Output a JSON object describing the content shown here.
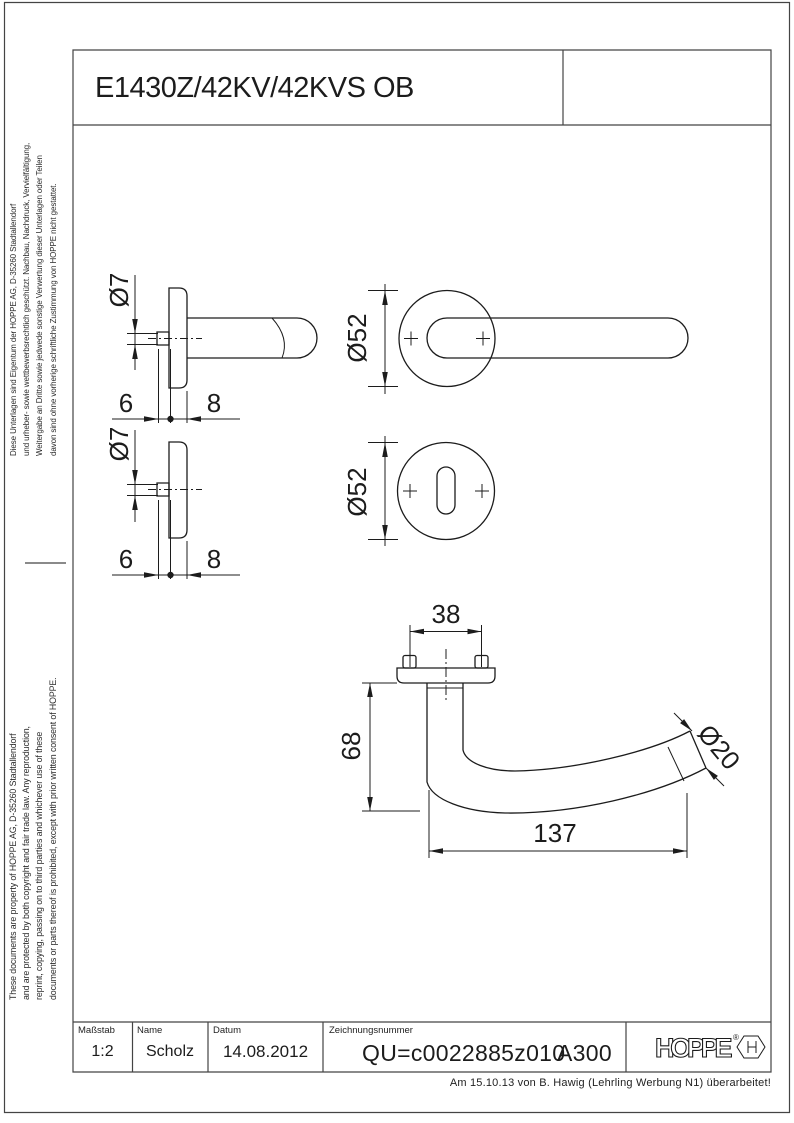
{
  "sheet": {
    "title": "E1430Z/42KV/42KVS OB",
    "note": "Am 15.10.13 von B. Hawig (Lehrling Werbung N1) überarbeitet!"
  },
  "legal": {
    "german": [
      "Diese Unterlagen sind Eigentum der HOPPE AG, D-35260 Stadtallendorf",
      "und urheber- sowie wettbewerbsrechtlich geschützt. Nachbau, Nachdruck, Vervielfältigung,",
      "Weitergabe an Dritte sowie jedwede sonstige Verwertung dieser Unterlagen oder Teilen",
      "davon sind ohne vorherige schriftliche Zustimmung von HOPPE nicht gestattet."
    ],
    "english": [
      "These documents are property of HOPPE AG, D-35260 Stadtallendorf",
      "and are protected by both copyright and fair trade law. Any reproduction,",
      "reprint, copying, passing on to third parties and whichever use of these",
      "documents or parts thereof is prohibited, except with prior written consent of HOPPE."
    ]
  },
  "title_block": {
    "masstab_label": "Maßstab",
    "masstab_value": "1:2",
    "name_label": "Name",
    "name_value": "Scholz",
    "datum_label": "Datum",
    "datum_value": "14.08.2012",
    "zeichnungsnummer_label": "Zeichnungsnummer",
    "zeichnungsnummer_value": "QU=c0022885z010",
    "revision": "A300",
    "logo_text": "HOPPE",
    "logo_registered": "®"
  },
  "dimensions": {
    "spindle_dia": "Ø7",
    "rose_dia": "Ø52",
    "offset": "6",
    "rose_thickness": "8",
    "screw_spacing": "38",
    "handle_height": "68",
    "handle_length": "137",
    "grip_dia": "Ø20"
  },
  "colors": {
    "line": "#1c1c1c",
    "background": "#ffffff"
  }
}
